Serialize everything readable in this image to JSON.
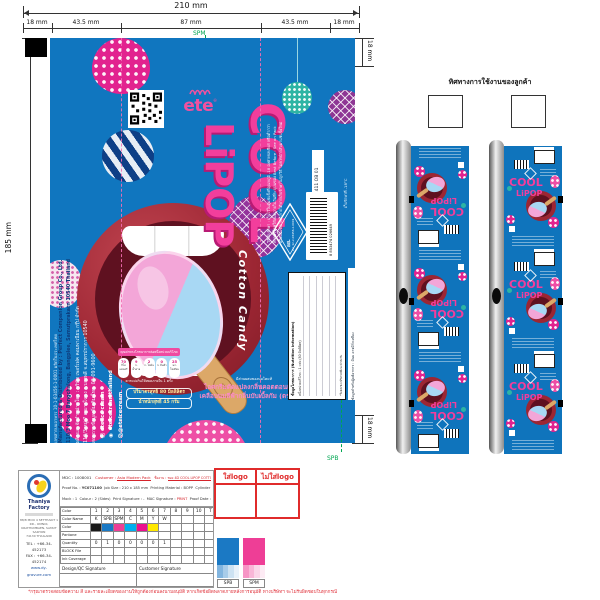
{
  "dimensions": {
    "total_width": "210 mm",
    "seg1": "18 mm",
    "seg2": "43.5 mm",
    "seg3": "87 mm",
    "seg4": "43.5 mm",
    "seg5": "18 mm",
    "height": "185 mm",
    "right_top": "18 mm",
    "right_bottom": "18 mm",
    "plate_mark_top": "SPM",
    "plate_mark_bottom": "SPB"
  },
  "artwork": {
    "brand": "ete",
    "brand_tm": "®",
    "product1": "COOL",
    "product2": "LiPOP",
    "flavor": "Cotton Candy",
    "stick_brand": "ete",
    "reg_line": "เลขสารบบอาหาร 10-1-03456-1-0001 ผลิตในประเทศไทย",
    "mfg_en1": "Manufactured & Distributed by : Perfect Companion Group Co., Ltd.",
    "mfg_en2": "110/3 Moo 7 Bangchalong, Bangplee, Samutprakarn 10540 Thailand",
    "mfg_th1": "ผลิตและจัดจำหน่ายโดย : บริษัท เพอร์เฟค คอมพาเนียน กรุ๊ป จำกัด",
    "mfg_th2": "110/3 หมู่ 7 ต.บางโฉลง อ.บางพลี จ.สมุทรปราการ 10540",
    "consumer": "สอบถามข้อมูลเพิ่มเติม โทร. 02-091-9600",
    "social_fb": "ete ice cream",
    "social_ig": "eteicecreamthailand",
    "social_at": "@eteicecream",
    "gda_title": "คุณค่าทางโภชนาการต่อหนึ่งหน่วยบริโภค",
    "gda1v": "70",
    "gda1u": "กิโลแคลอรี",
    "gda2v": "9",
    "gda2u": "ก. น้ำตาล",
    "gda3v": "2",
    "gda3u": "ก. ไขมัน",
    "gda4v": "0",
    "gda4u": "ก. อิ่มตัว",
    "gda5v": "25",
    "gda5u": "มก. โซเดียม",
    "gda_caption": "ควรแบ่งกินให้หมดภายใน 1 ครั้ง",
    "milk_line": "มีส่วนผสมของนมโคแท้",
    "desc1": "ไอศกรีมดัดแปลงกลิ่นคอตตอนแคนดี้",
    "desc2": "เคลือบนมสีฟ้ากลิ่นบับเบิ้ลกัม (ตราเอเต้)",
    "net1": "ปริมาตรสุทธิ 80 มิลลิลิตร",
    "net2": "น้ำหนักสุทธิ 45 กรัม",
    "storage1": "วิธีเก็บรักษา : เก็บไว้ในตู้แช่แข็งที่อุณหภูมิ -18 องศาเซลเซียส หรือต่ำกว่า",
    "storage2": "ควรบริโภคให้หมดภายในวันที่ระบุบนซอง Best Before : See on Pack",
    "storage3": "ผลิตภัณฑ์อาจละลายได้หากเก็บรักษาไม่ถูกวิธี ไม่ควรนำกลับมาแช่แข็งใหม่",
    "cold_line": "เก็บรักษาที่ -18°C",
    "job_code": "64 D134 411 OB 01",
    "barcode": "8 853474 026649",
    "fda_mark": "อย.",
    "fda_no": "สบ. 12-2-03456-2-0001",
    "nutrition_title": "ข้อมูลโภชนาการ (Nutrition Information)",
    "nutrition_sub": "หนึ่งหน่วยบริโภค : 1 แท่ง (80 มิลลิลิตร)",
    "nutrition_note": "*ร้อยละของปริมาณที่แนะนำต่อวัน",
    "allergen": "ข้อมูลสำหรับผู้แพ้อาหาร : มีนม อาจมีถั่วเหลือง"
  },
  "rolls": {
    "title": "ทิศทางการใช้งานของลูกค้า"
  },
  "spec": {
    "company": {
      "name": "Thaniya Factory",
      "addr1": "88/8 MOO 4 SETTHAKIT 1 RD., OMNOI,",
      "addr2": "KRATHUMBAEN, SAMUT SAKHON",
      "addr3": "74130 THAILAND",
      "tel": "TEL : +66-34-452173",
      "fax": "FAX : +66-34-452174",
      "web": "www.dy-gravure.com"
    },
    "header": {
      "mdc_l": "MDC :",
      "mdc_v": "1008001",
      "cust_l": "Customer :",
      "cust_v": "Asia Modern Pack",
      "job_l": "ชื่องาน :",
      "job_v": "ซอง 4D COOL LIPOP COTTON CANDY 80 ML.",
      "proof_l": "Proof No. :",
      "proof_v": "YC071100",
      "size_l": "Job Size :",
      "size_v": "210 x 185 mm",
      "mat_l": "Printing Material :",
      "mat_v": "BOPP",
      "cyl_l": "Cylinder :",
      "cyl_v": "CPP-84 (A)",
      "mock_l": "Mock :",
      "mock_v": "1",
      "colour_l": "Colour :",
      "colour_v": "2 (Sides)",
      "psig_l": "Print Signature :",
      "psig_v": "-",
      "msig_l": "MAC Signature :",
      "msig_v": "PRINT",
      "date_l": "Proof Date :",
      "date_v": "15/03/2022"
    },
    "color_table": {
      "label_sequence": "Color Sequence",
      "label_name": "Color Name",
      "label_color": "Color",
      "label_pantone": "Pantone",
      "label_quantity": "Quantity",
      "label_block": "BLOCK File",
      "label_ink": "Ink Coverage",
      "seq": [
        "1",
        "2",
        "3",
        "4",
        "5",
        "6",
        "7",
        "8",
        "9",
        "10",
        "T"
      ],
      "name": [
        "K",
        "SPB",
        "SPM",
        "C",
        "M",
        "Y",
        "W",
        "",
        "",
        "",
        ""
      ],
      "swatch": [
        "#1a1a1a",
        "#1b79c4",
        "#ee3e96",
        "#00aeef",
        "#ec0f8e",
        "#ffe800",
        "",
        "",
        "",
        "",
        ""
      ],
      "qty": [
        "0",
        "1",
        "0",
        "0",
        "0",
        "0",
        "1",
        "",
        "",
        "",
        ""
      ]
    },
    "signatures": {
      "design": "Design/QC Signature",
      "customer": "Customer Signature"
    }
  },
  "logo_boxes": {
    "with_logo": "ใส่logo",
    "without_logo": "ไม่ใส่logo"
  },
  "proof_swatches": {
    "s1": {
      "label": "SPB",
      "color": "#1b79c4"
    },
    "s2": {
      "label": "SPM",
      "color": "#ee3e96"
    }
  },
  "disclaimer": "*กรุณาตรวจสอบข้อความ สี และรายละเอียดของงานให้ถูกต้องก่อนลงนามอนุมัติ หากเกิดข้อผิดพลาดภายหลังการอนุมัติ ทางบริษัทฯ จะไม่รับผิดชอบในทุกกรณี"
}
